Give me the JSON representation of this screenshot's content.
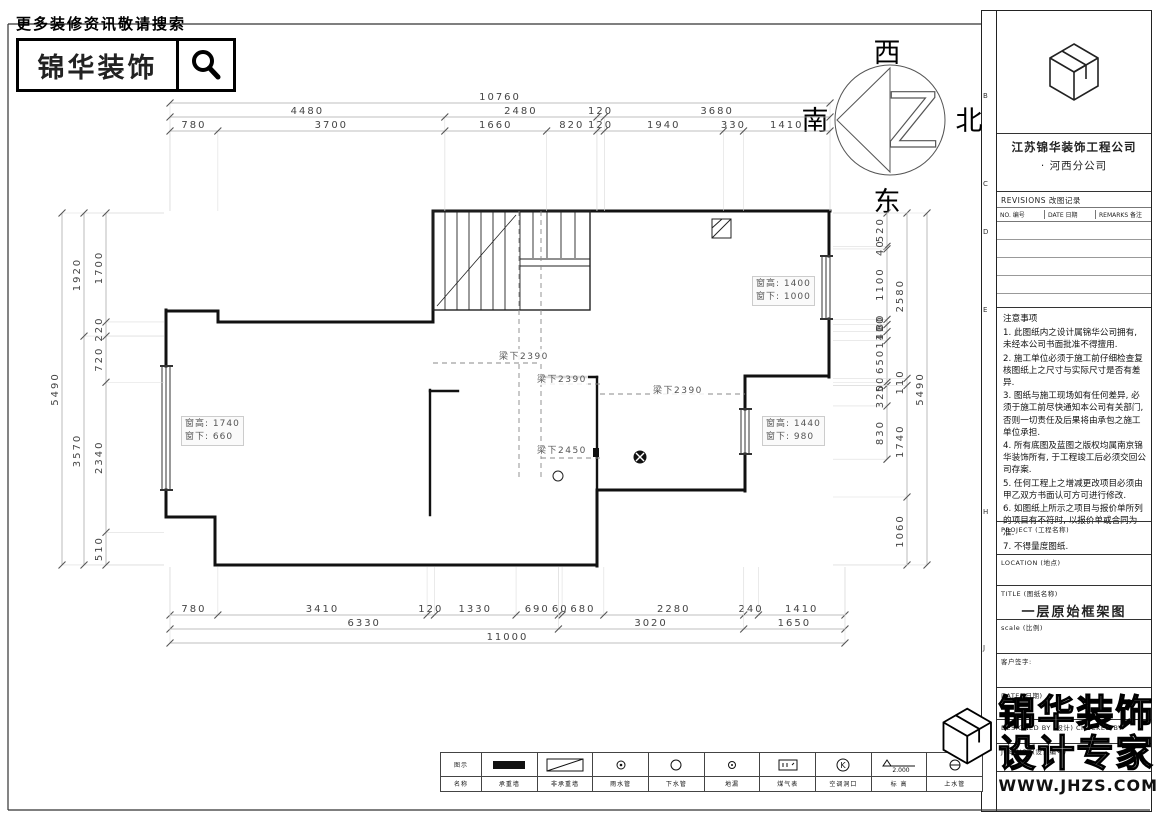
{
  "header": {
    "tagline": "更多装修资讯敬请搜索",
    "logo_text": "锦华装饰",
    "search_icon": "magnifier"
  },
  "compass": {
    "west": "西",
    "north": "北",
    "east": "东",
    "south": "南"
  },
  "plan": {
    "beam_labels": [
      {
        "text": "梁下2390"
      },
      {
        "text": "梁下2390"
      },
      {
        "text": "梁下2390"
      },
      {
        "text": "梁下2450"
      }
    ],
    "window_labels": [
      {
        "line1": "窗高: 1740",
        "line2": "窗下: 660"
      },
      {
        "line1": "窗高: 1400",
        "line2": "窗下: 1000"
      },
      {
        "line1": "窗高: 1440",
        "line2": "窗下: 980"
      }
    ]
  },
  "dimensions": {
    "top": [
      [
        "10760"
      ],
      [
        "4480",
        "2480",
        "120",
        "3680"
      ],
      [
        "780",
        "3700",
        "1660",
        "820",
        "120",
        "1940",
        "330",
        "1410"
      ]
    ],
    "bottom": [
      [
        "780",
        "3410",
        "120",
        "1330",
        "690",
        "60",
        "680",
        "2280",
        "240",
        "1410"
      ],
      [
        "6330",
        "3020",
        "1650"
      ],
      [
        "11000"
      ]
    ],
    "left": [
      [
        "5490"
      ],
      [
        "1920",
        "3570"
      ],
      [
        "1700",
        "220",
        "720",
        "2340",
        "510"
      ]
    ],
    "right": [
      [
        "520",
        "40",
        "1100",
        "80",
        "110",
        "140",
        "650",
        "50",
        "320",
        "830"
      ],
      [
        "2580",
        "110",
        "1740",
        "1060"
      ],
      [
        "5490"
      ]
    ]
  },
  "title_block": {
    "company": "江苏锦华装饰工程公司",
    "branch": "·  河西分公司",
    "revisions_title": "REVISIONS  改图记录",
    "revisions_cols": [
      "NO. 编号",
      "DATE 日期",
      "REMARKS 备注"
    ],
    "notes_title": "注意事项",
    "notes": [
      "1. 此图纸内之设计属锦华公司拥有, 未经本公司书面批准不得擅用.",
      "2. 施工单位必须于施工前仔细检查复核图纸上之尺寸与实际尺寸是否有差异.",
      "3. 图纸与施工现场如有任何差异, 必须于施工前尽快通知本公司有关部门, 否则一切责任及后果将由承包之施工单位承担.",
      "4. 所有底图及蓝图之版权均属南京锦华装饰所有, 于工程竣工后必须交回公司存案.",
      "5. 任何工程上之增减更改项目必须由甲乙双方书面认可方可进行修改.",
      "6. 如图纸上所示之项目与报价单所列的项目有不符时, 以报价单或合同为准.",
      "7. 不得量度图纸."
    ],
    "fields": [
      {
        "label": "PROJECT (工程名称)",
        "value": ""
      },
      {
        "label": "LOCATION (地点)",
        "value": ""
      },
      {
        "label": "TITLE (图纸名称)",
        "value": "一层原始框架图"
      },
      {
        "label": "scale  (比例)",
        "value": ""
      },
      {
        "label": "客户签字:",
        "value": ""
      },
      {
        "label": "DATE (日期)",
        "value": ""
      },
      {
        "label": "DESIGNED BY (设计)  CHECKED BY",
        "value": ""
      },
      {
        "label": "JOB NO. (设计编号)",
        "value": ""
      }
    ],
    "zone_letters": [
      "B",
      "C",
      "D",
      "E",
      "H",
      "J"
    ]
  },
  "legend": {
    "row_labels": [
      "图示",
      "名称"
    ],
    "items": [
      {
        "name": "承重墙"
      },
      {
        "name": "非承重墙"
      },
      {
        "name": "雨水管"
      },
      {
        "name": "下水管"
      },
      {
        "name": "地漏"
      },
      {
        "name": "煤气表"
      },
      {
        "name": "空调洞口"
      },
      {
        "name": "标 高",
        "value": "2.000"
      },
      {
        "name": "上水管"
      }
    ]
  },
  "watermark": {
    "line1": "锦华装饰",
    "line2": "设计专家",
    "url": "WWW.JHZS.COM"
  }
}
